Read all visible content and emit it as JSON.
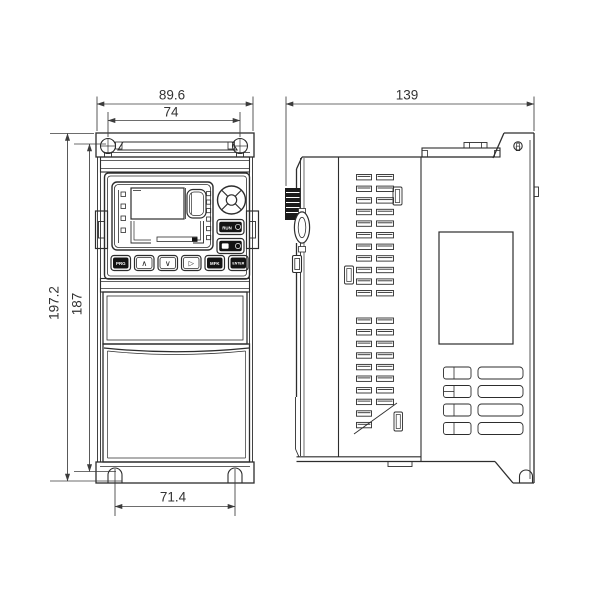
{
  "dimensions": {
    "front_overall_width_mm": "89.6",
    "top_mounting_hole_spacing_mm": "74",
    "side_depth_mm": "139",
    "overall_height_mm": "197.2",
    "mounting_hole_height_mm": "187",
    "bottom_mounting_hole_spacing_mm": "71.4"
  },
  "keypad": {
    "run_button": "RUN",
    "buttons": [
      "PRG",
      "∧",
      "∨",
      "▷",
      "MFK",
      "ENTER"
    ]
  },
  "colors": {
    "line": "#2d2d2d",
    "dimension_line": "#3c3c3c",
    "background": "#ffffff",
    "button_fill": "#141414"
  }
}
